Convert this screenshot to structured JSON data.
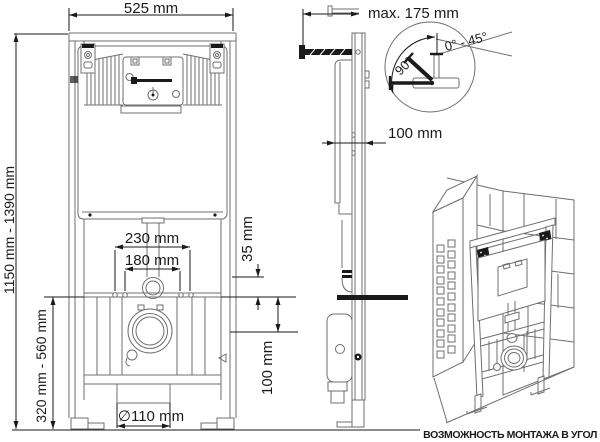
{
  "drawing": {
    "labels": {
      "frame_width": "525 mm",
      "wall_distance_max": "max. 175 mm",
      "rotation_full": "90°",
      "rotation_range": "0° - 45°",
      "frame_depth": "100 mm",
      "frame_height_range": "1150 mm - 1390 mm",
      "outlet_height_range": "320 mm - 560 mm",
      "fixing_width_outer": "230 mm",
      "fixing_width_inner": "180 mm",
      "inlet_offset": "35 mm",
      "outlet_height": "100 mm",
      "outlet_diameter": "∅110 mm"
    },
    "caption": "ВОЗМОЖНОСТЬ МОНТАЖА В УГОЛ",
    "colors": {
      "background": "#ffffff",
      "line": "#6f6f6f",
      "line_dark": "#4a4a4a",
      "ink": "#1a1a1a"
    }
  }
}
